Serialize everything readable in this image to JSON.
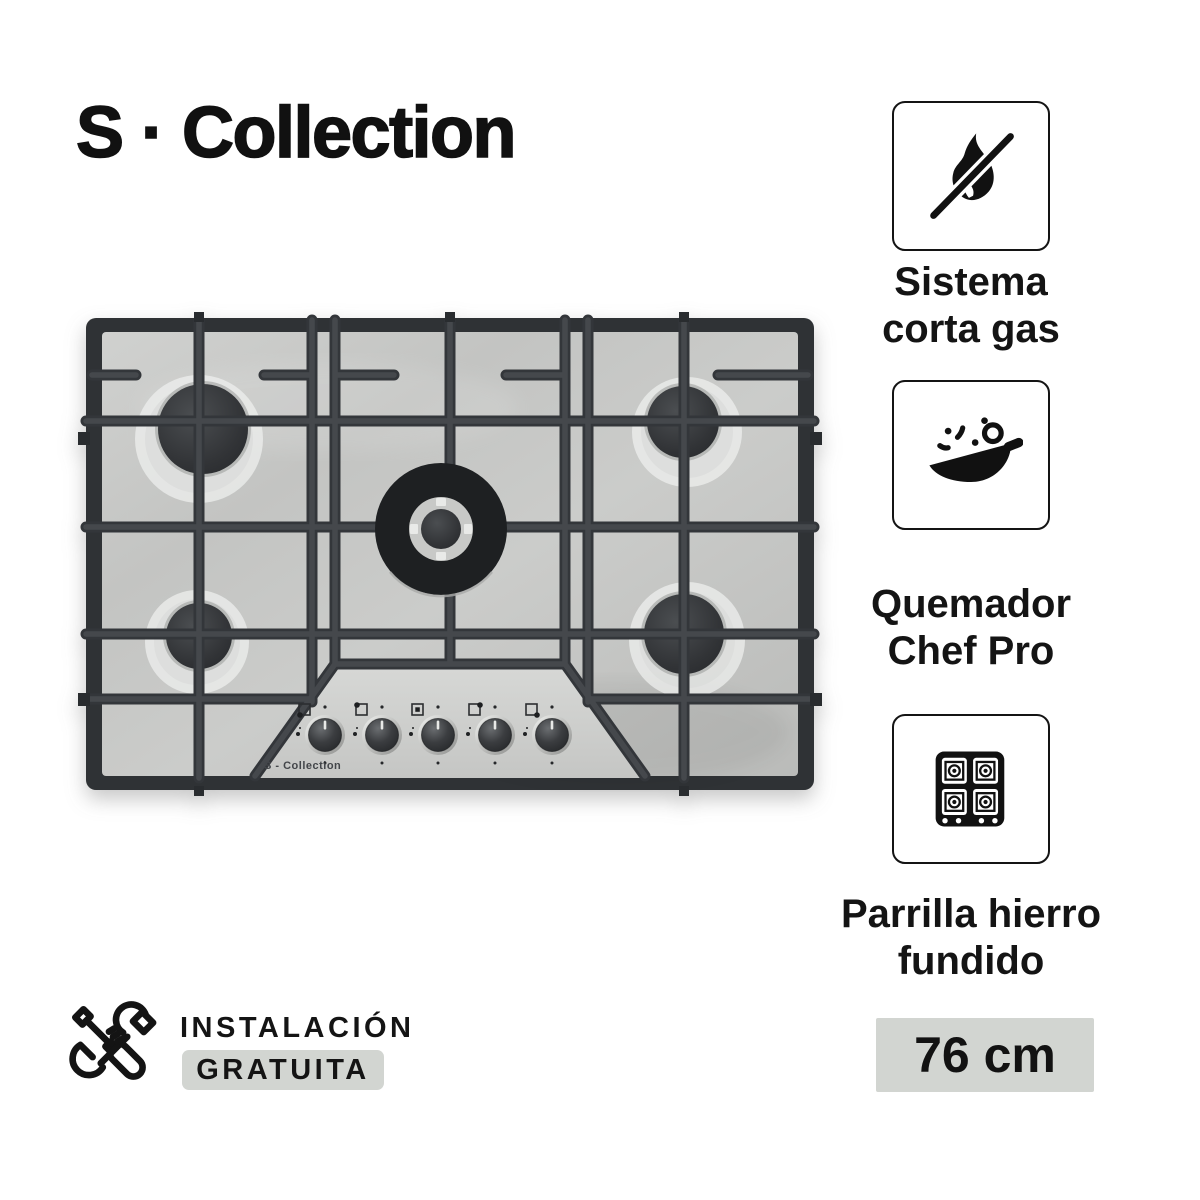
{
  "header": {
    "logo": "S · Collection"
  },
  "product": {
    "description": "5-burner stainless steel gas cooktop",
    "panel_brand": "S - Collection",
    "knob_count": 5,
    "icons": [
      "burner-position-square-icon",
      "flame-mini-icon",
      "knob-dial-icon"
    ],
    "colors": {
      "steel": "#c7c8c6",
      "grate": "#3e4145",
      "burner_cap": "#2f3134",
      "panel": "#d0d1cf"
    }
  },
  "features": [
    {
      "icon": "no-flame-icon",
      "lines": [
        "Sistema",
        "corta gas"
      ]
    },
    {
      "icon": "chef-pan-icon",
      "lines": [
        "Quemador",
        "Chef Pro"
      ]
    },
    {
      "icon": "cast-iron-grate-icon",
      "lines": [
        "Parrilla hierro",
        "fundido"
      ]
    }
  ],
  "size_badge": {
    "label": "76 cm",
    "background": "#d2d5d1"
  },
  "installation": {
    "icon": "tools-icon",
    "line1": "INSTALACIÓN",
    "line2": "GRATUITA",
    "highlight": "#d2d5d1"
  }
}
